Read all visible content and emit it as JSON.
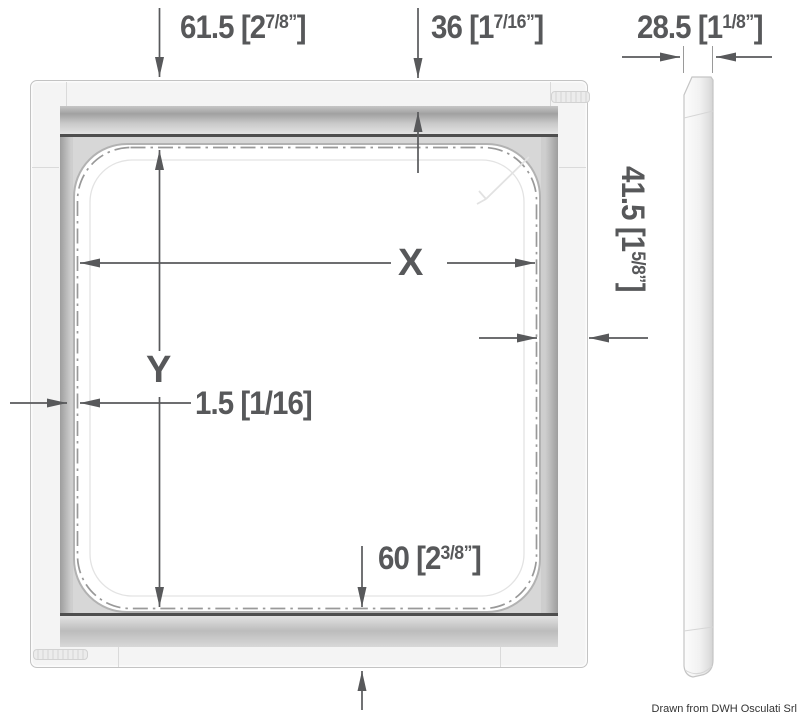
{
  "credit": "Drawn from DWH Osculati Srl",
  "dimensions": {
    "top_left": {
      "prefix": "61.5 [2",
      "fraction": "7/8”",
      "suffix": "]"
    },
    "top_middle": {
      "prefix": "36 [1",
      "fraction": "7/16”",
      "suffix": "]"
    },
    "top_right": {
      "prefix": "28.5 [1",
      "fraction": "1/8”",
      "suffix": "]"
    },
    "right_side": {
      "prefix": "41.5 [1",
      "fraction": "5/8”",
      "suffix": "]"
    },
    "bottom": {
      "prefix": "60 [2",
      "fraction": "3/8”",
      "suffix": "]"
    },
    "opening_width": {
      "label": "X"
    },
    "opening_height": {
      "label": "Y"
    },
    "edge_gap": {
      "label": "1.5 [1/16]"
    }
  },
  "colors": {
    "dimension_ink": "#58595b",
    "dash_dot_line": "#999999",
    "frame_fill": "#f4f4f4",
    "rail_dark_line": "#4e4e4e"
  }
}
